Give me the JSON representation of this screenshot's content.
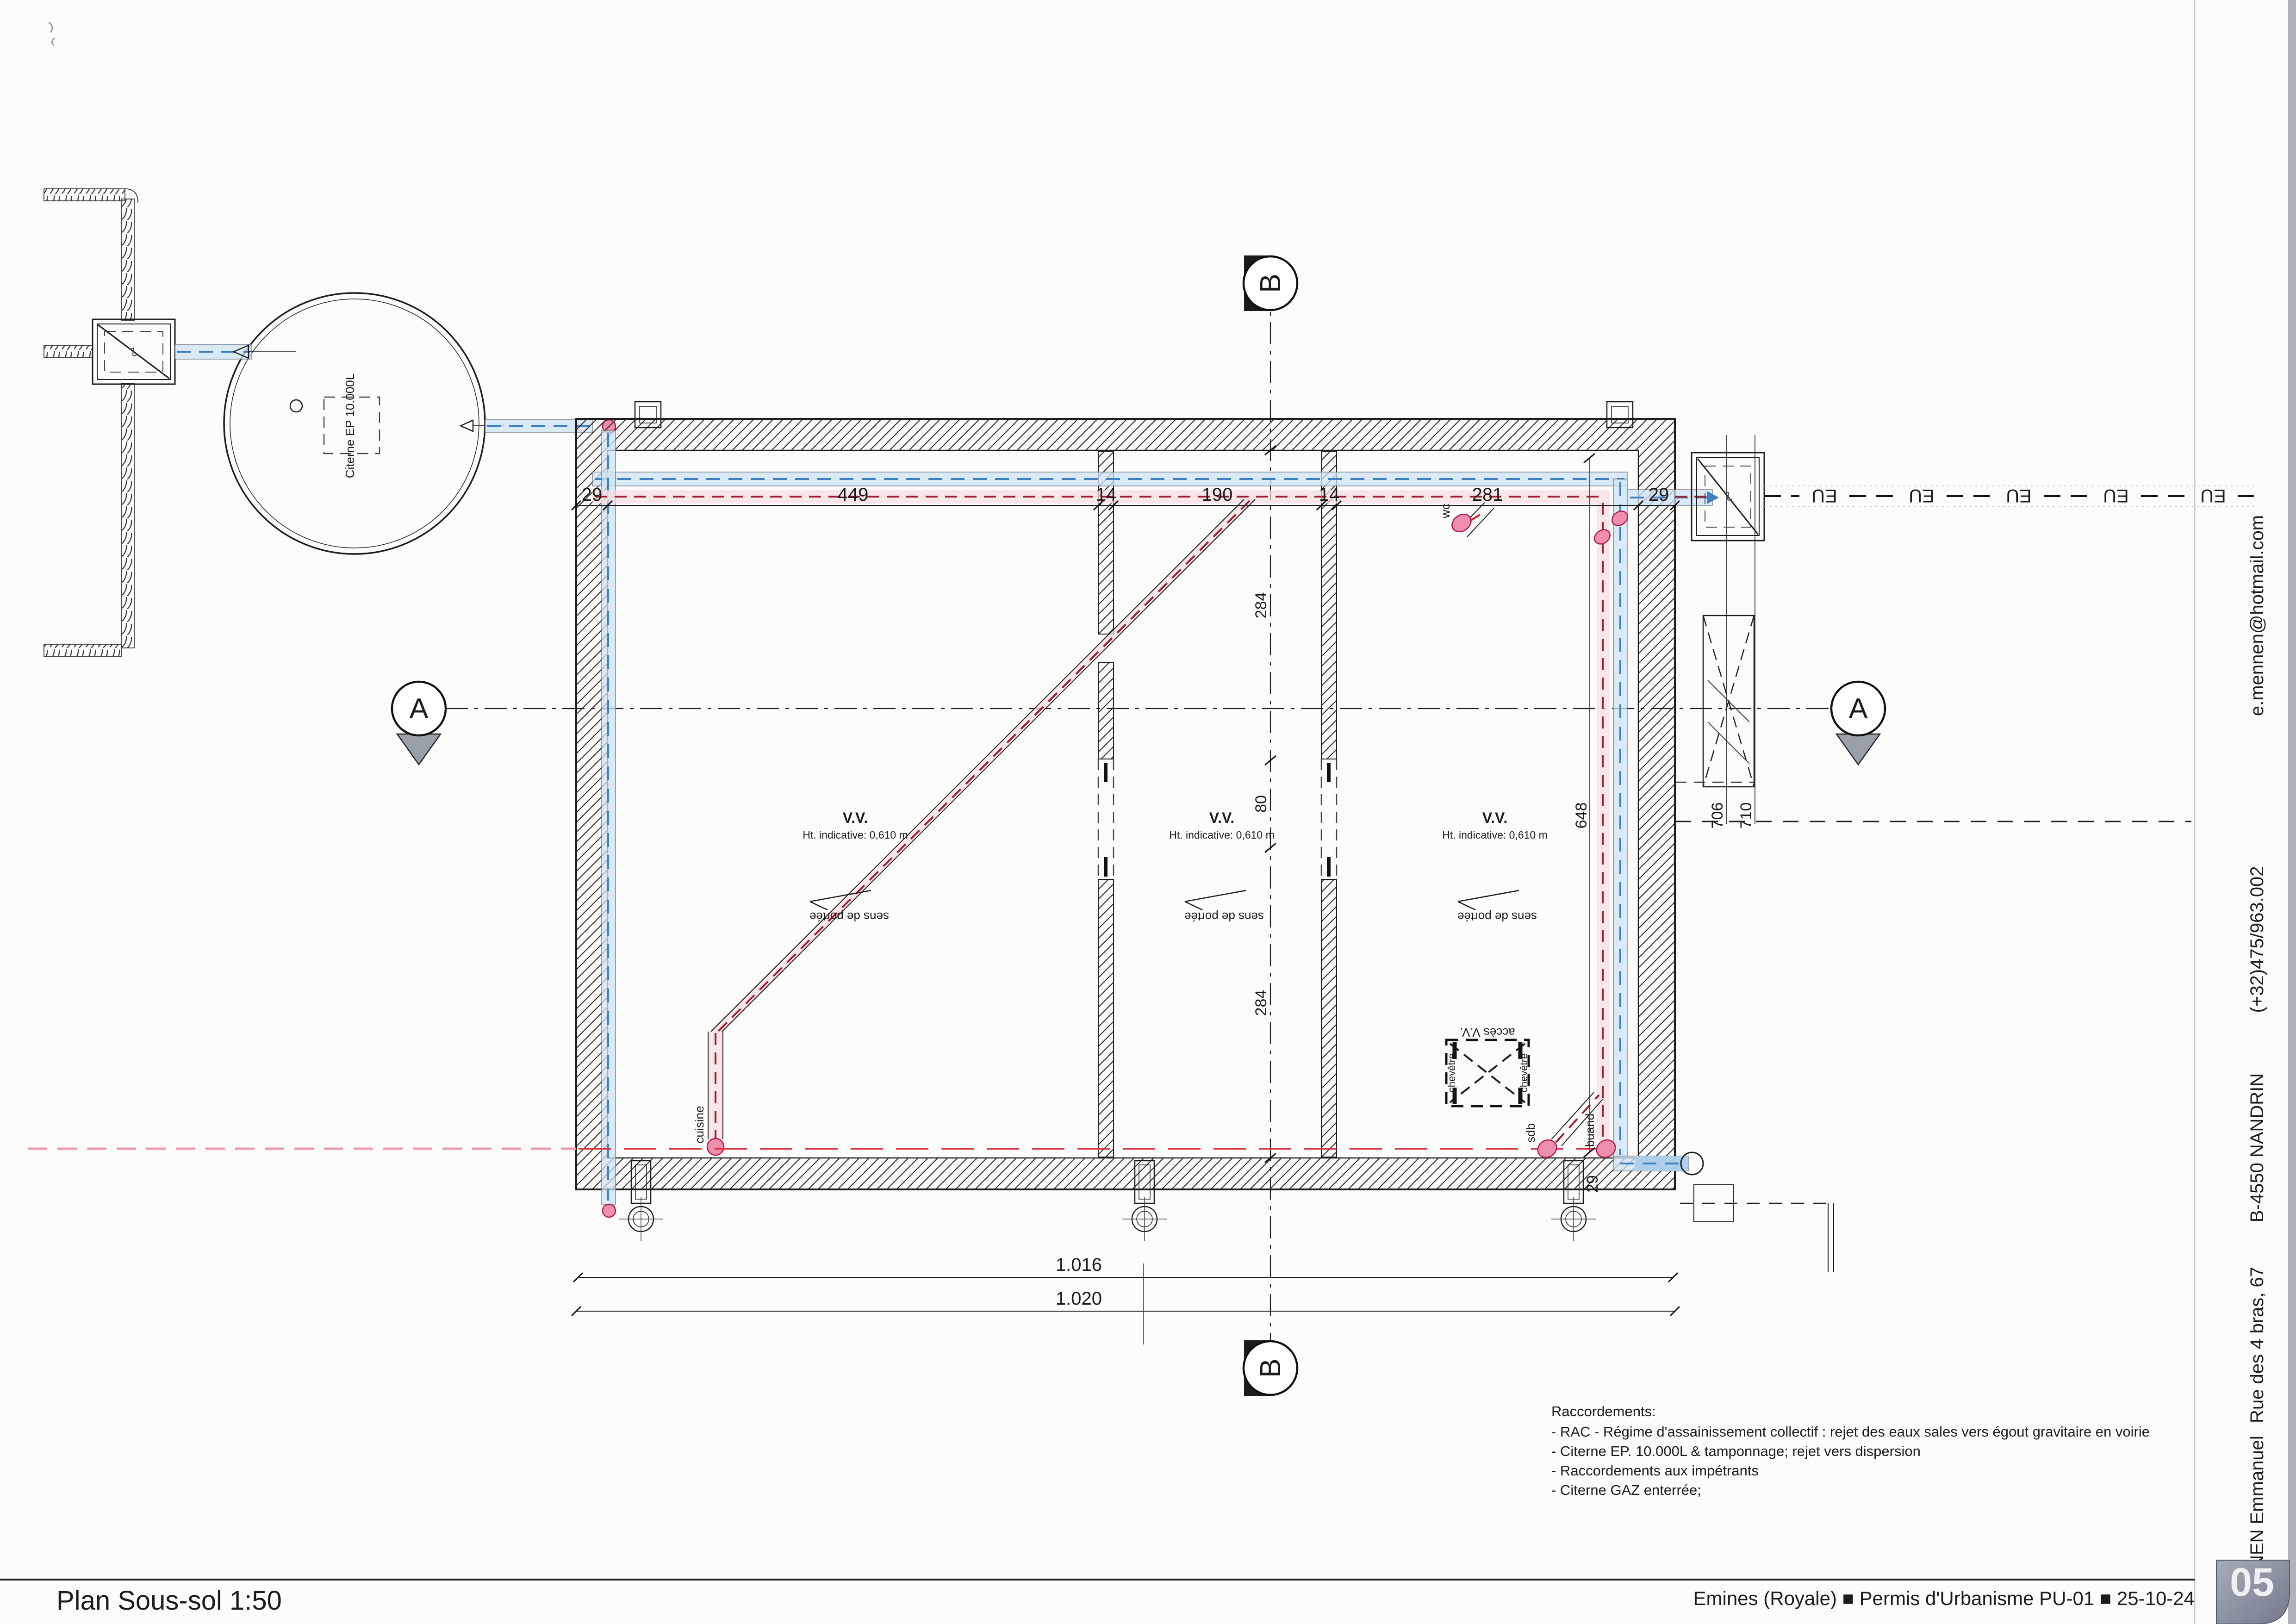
{
  "page": {
    "title": "Plan Sous-sol 1:50"
  },
  "title_block": {
    "text": "Emines (Royale) ■ Permis d'Urbanisme PU-01  ■ 25-10-24",
    "page_number": "05"
  },
  "sidebar": {
    "items": [
      "e.mennen@hotmail.com",
      "(+32)475/963.002",
      "B-4550 NANDRIN",
      "Rue des 4 bras, 67",
      "MENNEN Emmanuel"
    ]
  },
  "notes": {
    "heading": "Raccordements:",
    "lines": [
      "- RAC - Régime d'assainissement collectif : rejet des eaux sales vers égout gravitaire en voirie",
      "- Citerne EP. 10.000L & tamponnage; rejet vers dispersion",
      "- Raccordements aux impétrants",
      "- Citerne GAZ enterrée;"
    ]
  },
  "cistern": {
    "label": "Citerne EP 10.000L"
  },
  "rooms": [
    {
      "title": "V.V.",
      "height": "Ht. indicative: 0,610 m",
      "span": "sens de portée"
    },
    {
      "title": "V.V.",
      "height": "Ht. indicative: 0,610 m",
      "span": "sens de portée"
    },
    {
      "title": "V.V.",
      "height": "Ht. indicative: 0,610 m",
      "span": "sens de portée"
    }
  ],
  "dimensions": {
    "top": [
      "29",
      "449",
      "14",
      "190",
      "14",
      "281",
      "29"
    ],
    "room_vertical": [
      "284",
      "80",
      "284"
    ],
    "right": [
      "648"
    ],
    "site": [
      "706",
      "710"
    ],
    "bottom": [
      "1.016",
      "1.020"
    ],
    "bottom_wall": "29"
  },
  "labels": {
    "acces": "accès V.V.",
    "chevetre": "chevêtre",
    "wc": "wc",
    "sdb": "sdb",
    "buand": "buand",
    "cuisine": "cuisine",
    "eu": "EU"
  },
  "markers": {
    "a": "A",
    "b": "B"
  }
}
